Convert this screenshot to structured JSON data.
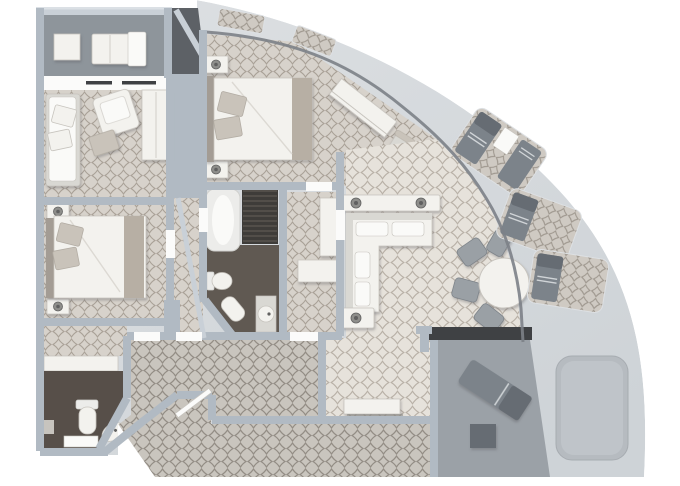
{
  "plan": {
    "type": "suite-floor-plan",
    "style": "top-down 3D render",
    "shape": "quarter-round suite with wrap-around curved balcony on the right"
  },
  "palette": {
    "bg": "#ffffff",
    "hull": "#ced3d7",
    "hullLight": "#dde0e3",
    "wall": "#b1bac3",
    "wallLight": "#c9d0d7",
    "wallDark": "#5d6166",
    "headerDark": "#3f4144",
    "doorBand": "#fbfbfa",
    "doorTrack": "#3f4144",
    "carpetRoom": "#d7d2cb",
    "latRoom": "#a9a197",
    "carpetLiving": "#e6e2db",
    "latLiving": "#b8b0a6",
    "carpetHall": "#c9c5be",
    "latHall": "#938d85",
    "carpetRecess": "#cfcac3",
    "latRecess": "#9e978e",
    "floorDark": "#605952",
    "floorDark2": "#574f49",
    "veranda": "#8e959b",
    "deck": "#9ba1a7",
    "spa": "#b6bbc0",
    "spaInner": "#bfc4c9",
    "furn": "#f3f2ee",
    "furnEdge": "#c7c4be",
    "furnInner": "#fafaf8",
    "sofaBase": "#d9d8d3",
    "pillow": "#c9c3ba",
    "pillowEdge": "#b3ada4",
    "runner": "#b7afa4",
    "headboard": "#a39c94",
    "crease": "#dcd9d3",
    "tubFill": "#ececea",
    "tubEdge": "#d0d0cd",
    "showerDark": "#3e3c39",
    "showerSlat": "#58554f",
    "lounger": "#7c838a",
    "loungerDark": "#666c73",
    "towel": "#d0d4d7",
    "chair": "#9aa0a5",
    "chairEdge": "#7e848a",
    "knob": "#8e8e8b",
    "knobDark": "#616160",
    "windowLine": "#7c8187"
  },
  "rooms": [
    {
      "id": "forward-veranda",
      "furniture": [
        "sun-bed",
        "side-table"
      ]
    },
    {
      "id": "sitting-room",
      "furniture": [
        "sofa",
        "armchair",
        "ottoman",
        "wardrobe"
      ]
    },
    {
      "id": "bedroom-2",
      "furniture": [
        "double-bed",
        "nightstand",
        "nightstand"
      ]
    },
    {
      "id": "bathroom-2",
      "furniture": [
        "vanity-counter",
        "toilet",
        "step",
        "sink"
      ]
    },
    {
      "id": "master-bedroom",
      "furniture": [
        "king-bed",
        "nightstand",
        "nightstand",
        "desk",
        "desk-chair"
      ]
    },
    {
      "id": "master-bathroom",
      "furniture": [
        "bathtub",
        "shower",
        "toilet",
        "bidet",
        "sink-vanity"
      ]
    },
    {
      "id": "walk-in-closet",
      "furniture": [
        "shelving",
        "shelf-unit"
      ]
    },
    {
      "id": "living-room",
      "furniture": [
        "l-shaped-sofa",
        "console-table",
        "table-lamp",
        "table-lamp",
        "side-console",
        "credenza"
      ]
    },
    {
      "id": "dining-area",
      "furniture": [
        "round-dining-table",
        "dining-chair",
        "dining-chair",
        "dining-chair",
        "dining-chair"
      ]
    },
    {
      "id": "entry-hall",
      "furniture": [
        "entrance-door"
      ]
    },
    {
      "id": "wrap-around-balcony",
      "recesses": 5,
      "furniture": [
        "lounger",
        "lounger",
        "lounger",
        "lounger"
      ]
    },
    {
      "id": "aft-deck",
      "furniture": [
        "chaise-lounge",
        "side-table",
        "spa-pad"
      ]
    }
  ]
}
